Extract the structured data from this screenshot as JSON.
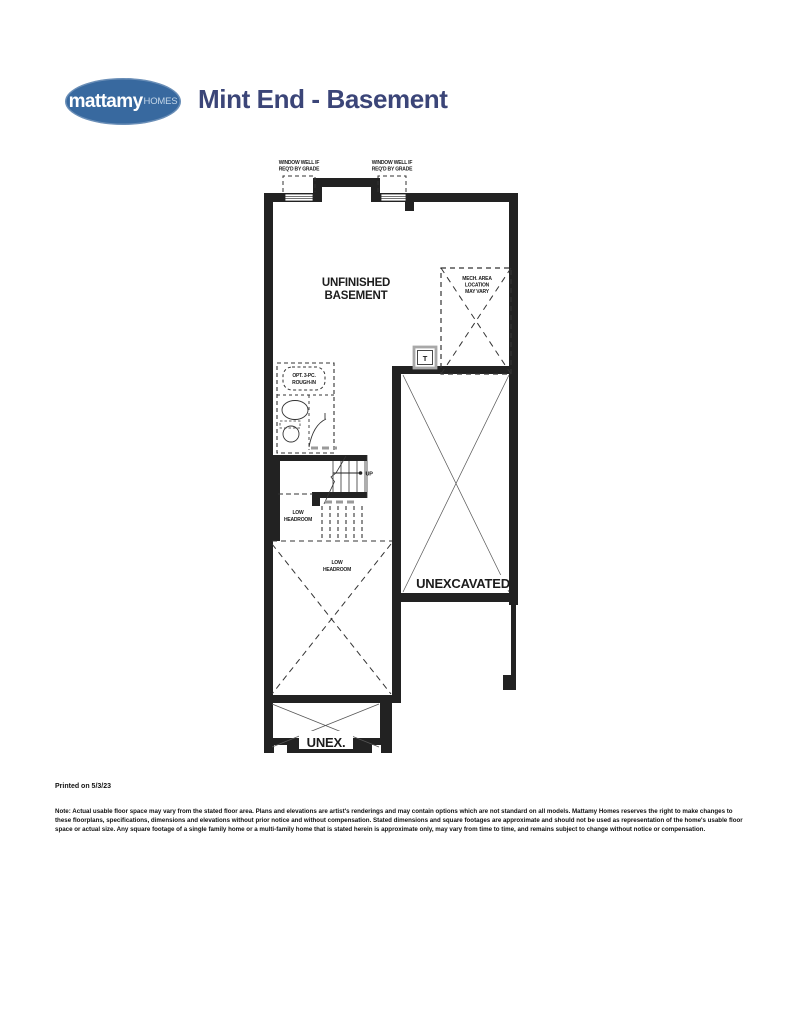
{
  "header": {
    "logo": {
      "brand_bold": "mattamy",
      "brand_light": "HOMES"
    },
    "title": "Mint End - Basement"
  },
  "plan": {
    "window_well_left": [
      "WINDOW WELL IF",
      "REQ'D BY GRADE"
    ],
    "window_well_right": [
      "WINDOW WELL IF",
      "REQ'D BY GRADE"
    ],
    "room_title": [
      "UNFINISHED",
      "BASEMENT"
    ],
    "mech_area": [
      "MECH. AREA",
      "LOCATION",
      "MAY VARY"
    ],
    "tank_label": "T",
    "rough_in": [
      "OPT. 3-PC.",
      "ROUGH-IN"
    ],
    "up_label": "UP",
    "low_headroom_stairs": [
      "LOW",
      "HEADROOM"
    ],
    "low_headroom_area": [
      "LOW",
      "HEADROOM"
    ],
    "unexcavated_label": "UNEXCAVATED",
    "unex_label": "UNEX."
  },
  "footer": {
    "printed_on": "Printed on 5/3/23",
    "disclaimer": "Note: Actual usable floor space may vary from the stated floor area. Plans and elevations are artist's renderings and may contain options which are not standard on all models. Mattamy Homes reserves the right to make changes to these floorplans, specifications, dimensions and elevations without prior notice and without compensation. Stated dimensions and square footages are approximate and should not be used as representation of the home's usable floor space or actual size. Any square footage of a single family home or a multi-family home that is stated herein is approximate only, may vary from time to time, and remains subject to change without notice or compensation."
  },
  "colors": {
    "logo_blue": "#38699f",
    "title_navy": "#3b4578",
    "wall_black": "#222222",
    "gray_dash": "#9a9a9a"
  }
}
